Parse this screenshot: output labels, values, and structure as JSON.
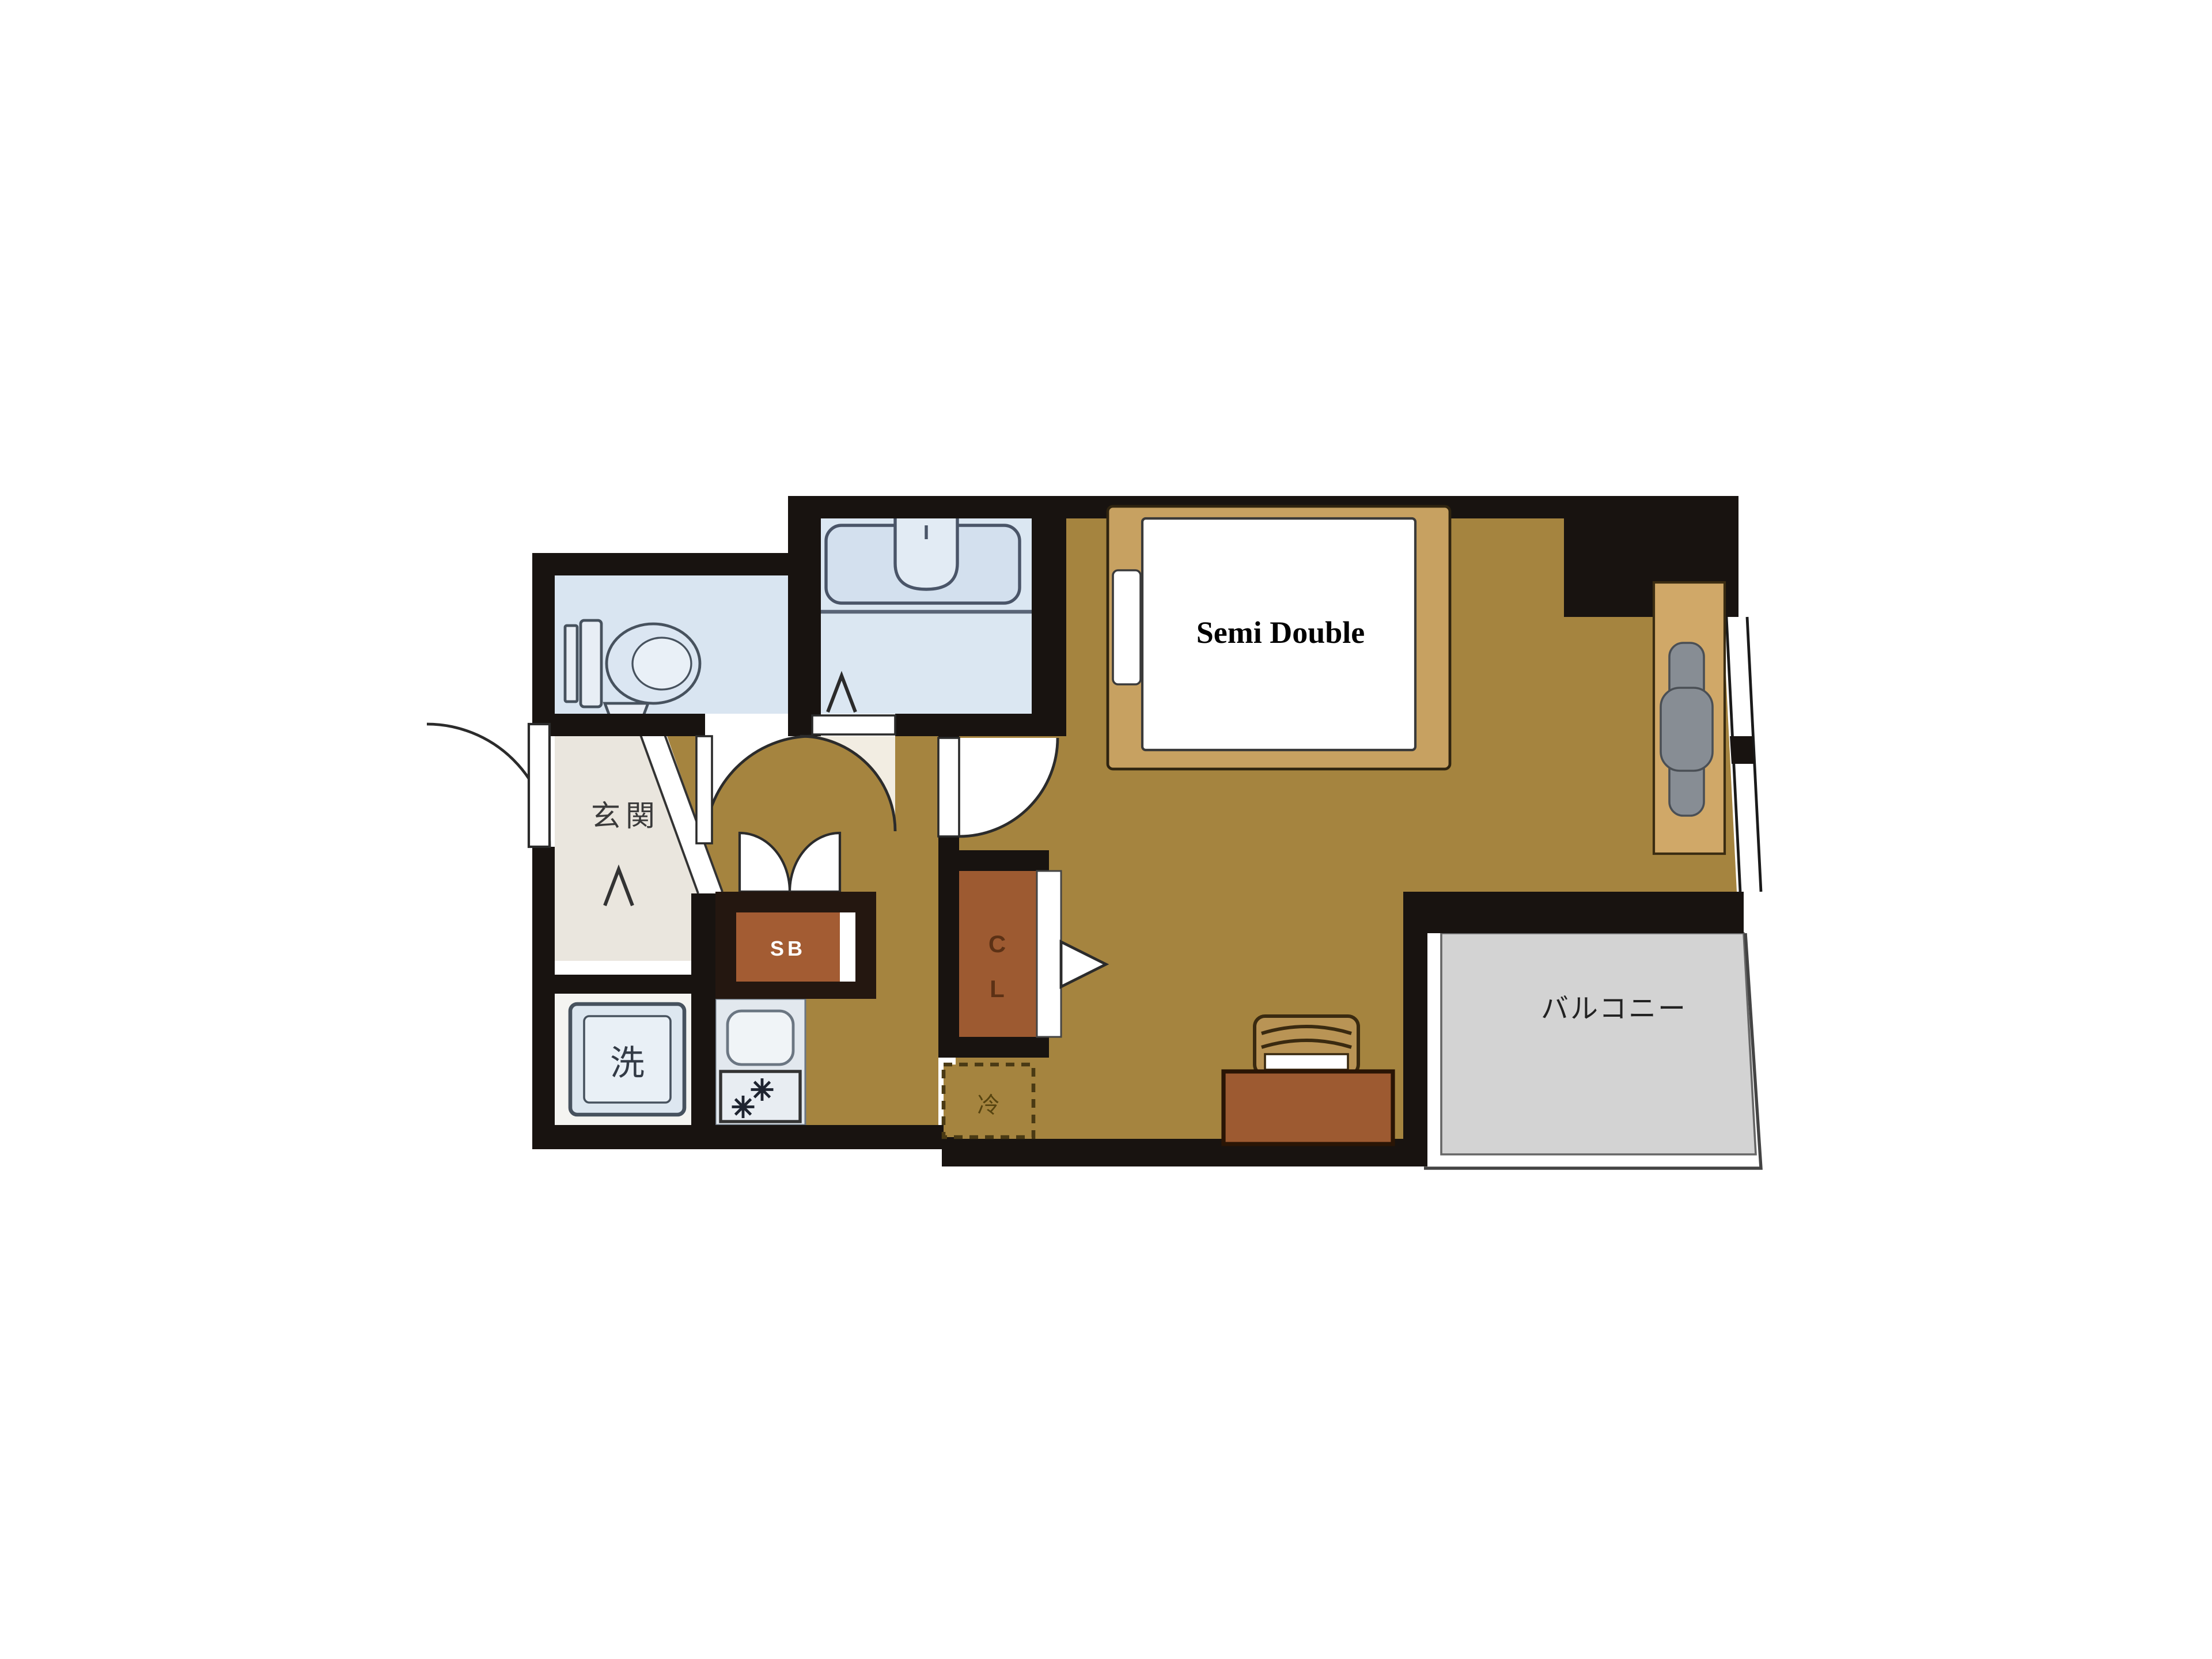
{
  "floor_plan": {
    "type": "apartment-1K-floor-plan",
    "rooms": {
      "entrance": {
        "label": "玄関"
      },
      "washing_machine": {
        "label": "洗"
      },
      "shoe_box": {
        "label": "SB"
      },
      "closet": {
        "char_top": "C",
        "char_bottom": "L"
      },
      "refrigerator": {
        "label": "冷"
      },
      "balcony": {
        "label": "バルコニー"
      },
      "bed": {
        "label": "Semi Double"
      },
      "toilet": {
        "label": ""
      },
      "bathroom": {
        "label": ""
      }
    },
    "colors": {
      "wall": "#181310",
      "main_floor": "#a5843f",
      "entrance_floor": "#eae6de",
      "wet_room_fill": "#d9e5f1",
      "kitchen_fill": "#e2e8ee",
      "washer_room_fill": "#f4f4f1",
      "balcony_fill": "#d3d3d3",
      "bed_frame": "#c7a161",
      "storage_brown": "#9d5a31",
      "chair_gray": "#878d94",
      "mattress": "#ffffff"
    }
  }
}
